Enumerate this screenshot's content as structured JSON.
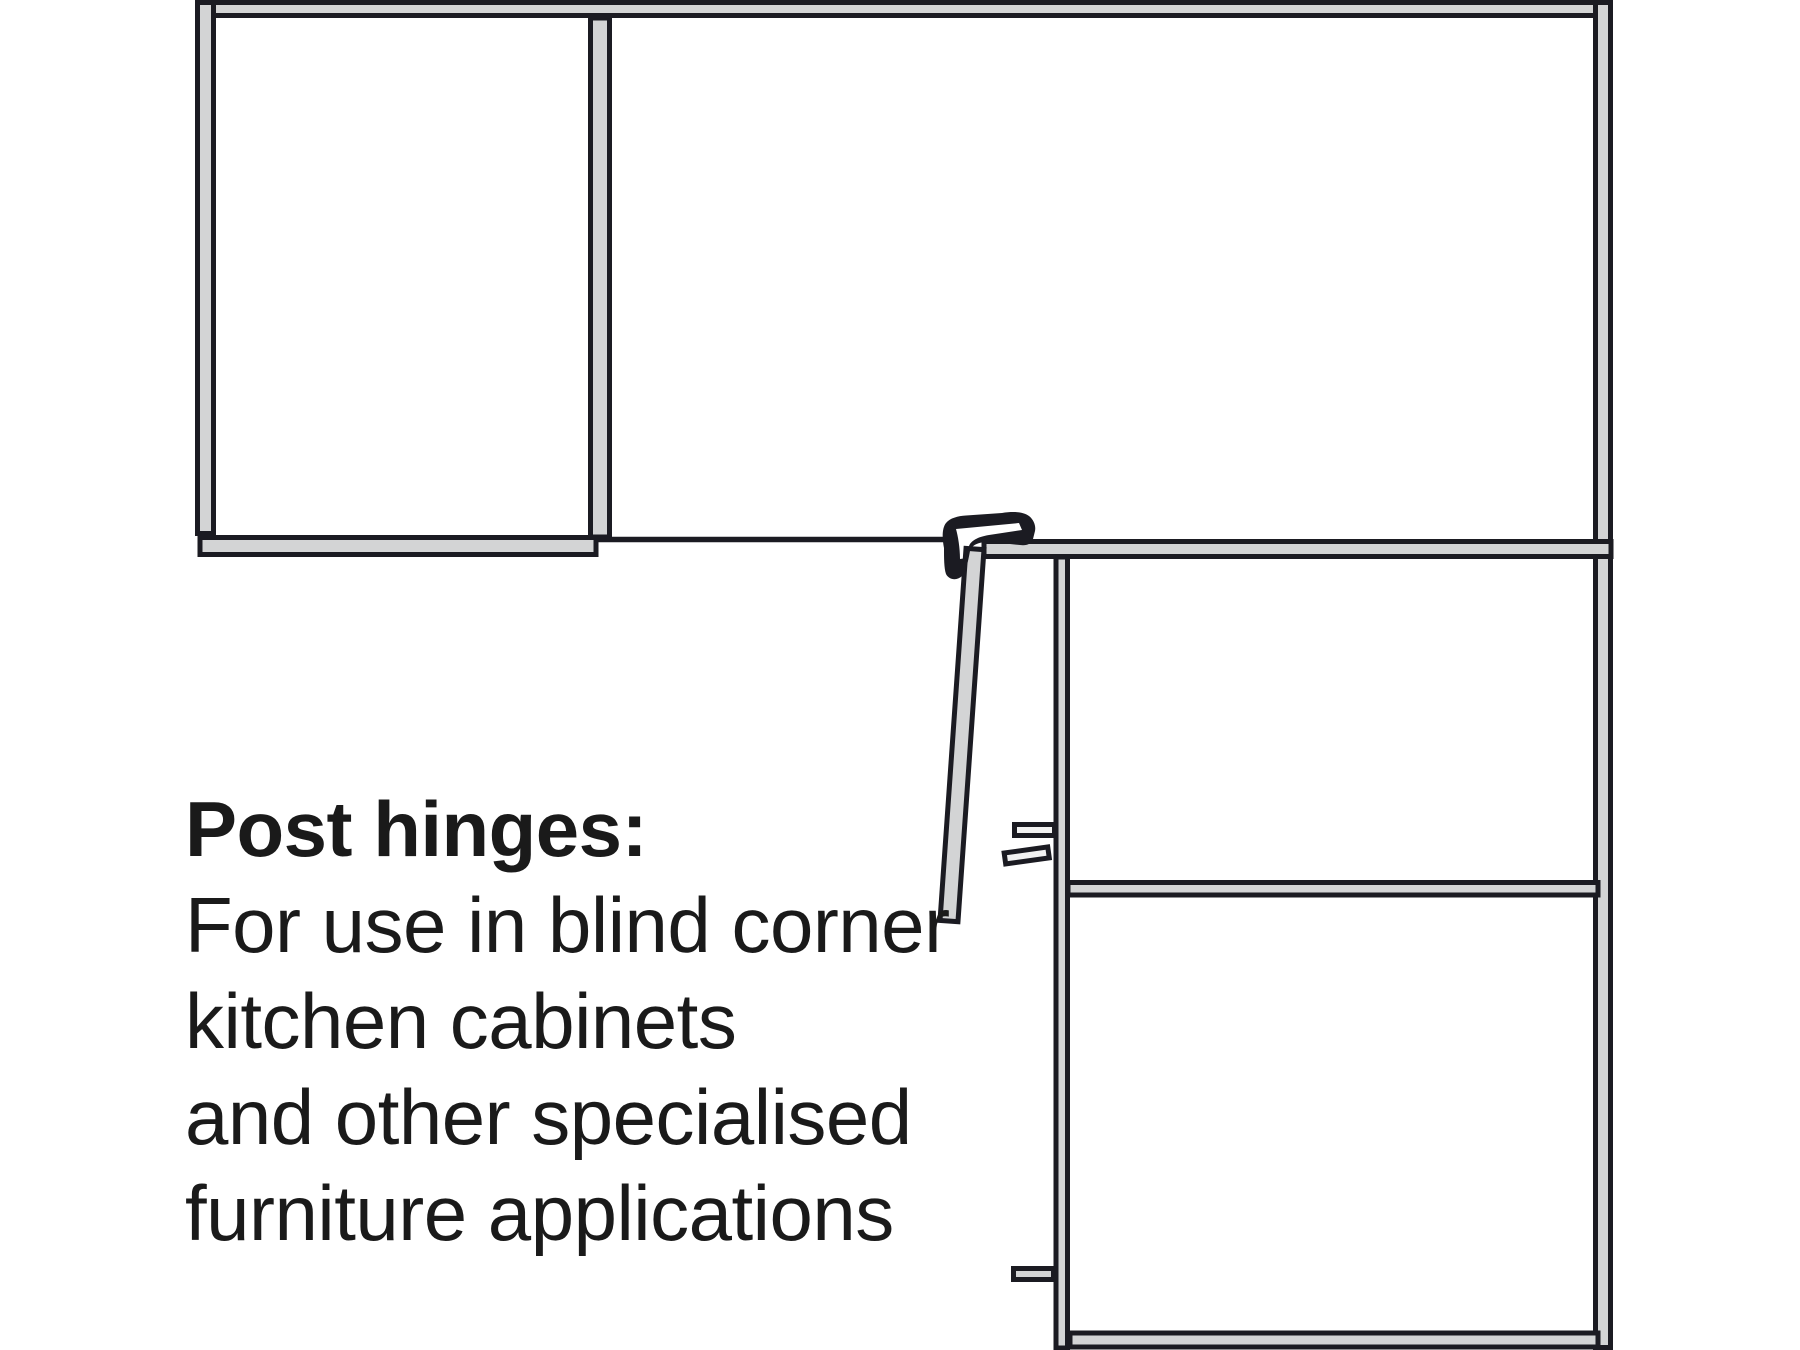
{
  "colors": {
    "background": "#ffffff",
    "outline": "#1b1b22",
    "panel_fill": "#d3d4d5",
    "peg_fill": "#f2f2f2",
    "text": "#1a1a1a"
  },
  "caption": {
    "title": "Post hinges:",
    "lines": [
      "For use in blind corner",
      "kitchen cabinets",
      "and other specialised",
      "furniture applications"
    ]
  }
}
